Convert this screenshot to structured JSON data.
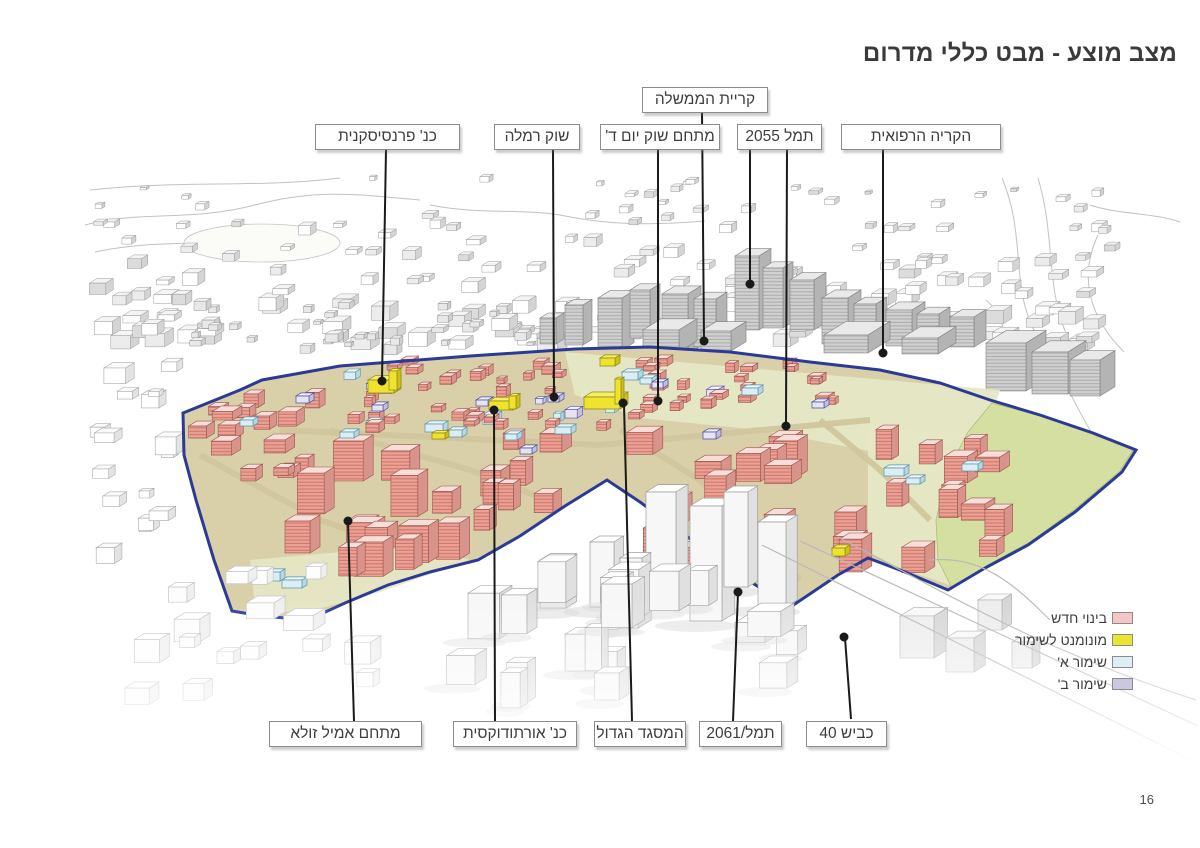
{
  "page": {
    "title": "מצב מוצע - מבט כללי מדרום",
    "page_number": "16"
  },
  "callouts": {
    "top": [
      {
        "id": "kiryat-hamemshala",
        "text": "קריית הממשלה"
      },
      {
        "id": "franciscan-church",
        "text": "כנ' פרנסיסקנית"
      },
      {
        "id": "shuk-ramla",
        "text": "שוק רמלה"
      },
      {
        "id": "shuk-yom-d",
        "text": "מתחם שוק יום ד'"
      },
      {
        "id": "taml-2055",
        "text": "תמל 2055"
      },
      {
        "id": "medical-campus",
        "text": "הקריה הרפואית"
      }
    ],
    "bottom": [
      {
        "id": "emil-zola",
        "text": "מתחם אמיל זולא"
      },
      {
        "id": "orthodox-church",
        "text": "כנ' אורתודוקסית"
      },
      {
        "id": "great-mosque",
        "text": "המסגד הגדול"
      },
      {
        "id": "taml-2061",
        "text": "תמל/2061"
      },
      {
        "id": "road-40",
        "text": "כביש 40"
      }
    ]
  },
  "legend": {
    "items": [
      {
        "label": "בינוי חדש",
        "color": "#f4c6c8"
      },
      {
        "label": "מונומנט לשימור",
        "color": "#ece433"
      },
      {
        "label": "שימור א'",
        "color": "#ddeff4"
      },
      {
        "label": "שימור ב'",
        "color": "#cbc7e2"
      }
    ]
  },
  "map": {
    "palette": {
      "ground_tan": "#d9cfa9",
      "street_tan": "#cfc49c",
      "patch_green": "#e6e7c5",
      "park_green": "#d5dfa2",
      "park_stroke": "#aebf76",
      "wall_pink": "#eda093",
      "wall_pink_side": "#d8938a",
      "roof_pink": "#f8ded8",
      "pink_stroke": "#9c554e",
      "monument_yellow": "#efe32f",
      "monument_side": "#cdbf1d",
      "monument_roof": "#f6ef66",
      "monument_stroke": "#8e8712",
      "preserve_a": "#daeef3",
      "preserve_a_side": "#b7d6de",
      "preserve_a_roof": "#ecf7f9",
      "preserve_a_stroke": "#5d93ab",
      "preserve_b": "#e6e4f2",
      "preserve_b_side": "#c3bfdd",
      "preserve_b_roof": "#f1eff8",
      "preserve_b_stroke": "#4e51a0",
      "boundary_blue": "#2b3a96",
      "bg_stroke": "#9a9a9a",
      "bg_side": "#d4d4d4",
      "mid_side": "#b4b4b4",
      "mid_roof": "#e9e9e9",
      "mid_stroke": "#808080",
      "fg_wall": "#f7f7f7",
      "fg_side": "#e0e0e0",
      "fg_stroke": "#9e9e9e",
      "sketch_line": "#c2c2c2",
      "leader_black": "#1a1a1a"
    }
  }
}
